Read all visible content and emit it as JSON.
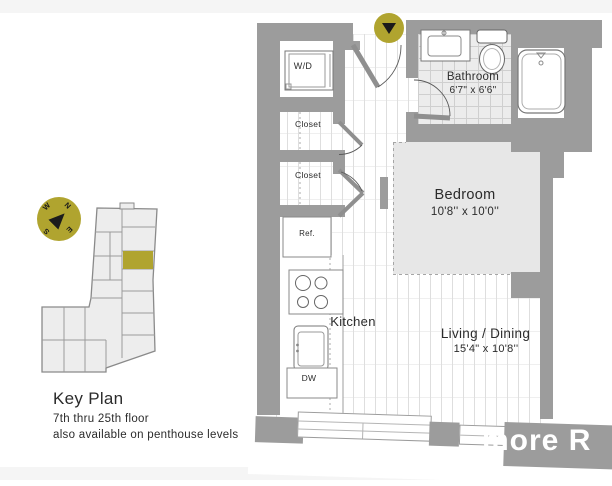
{
  "key_plan": {
    "title": "Key Plan",
    "floors": "7th thru 25th floor",
    "availability": "also available on penthouse levels",
    "compass": {
      "n": "N",
      "e": "E",
      "s": "S",
      "w": "W"
    }
  },
  "rooms": {
    "wd": {
      "label": "W/D"
    },
    "closet_upper": {
      "label": "Closet"
    },
    "closet_lower": {
      "label": "Closet"
    },
    "ref": {
      "label": "Ref."
    },
    "dw": {
      "label": "DW"
    },
    "kitchen": {
      "label": "Kitchen"
    },
    "bathroom": {
      "label": "Bathroom",
      "dims": "6'7\" x 6'6\""
    },
    "bedroom": {
      "label": "Bedroom",
      "dims": "10'8'' x 10'0''"
    },
    "living": {
      "label": "Living / Dining",
      "dims": "15'4\" x 10'8''"
    }
  },
  "watermark": {
    "text": "more R"
  },
  "colors": {
    "accent_olive": "#b0a42f",
    "wall_gray": "#9c9c9c",
    "bedroom_fill": "#e7e7e7",
    "tile_fill": "#ececec"
  }
}
